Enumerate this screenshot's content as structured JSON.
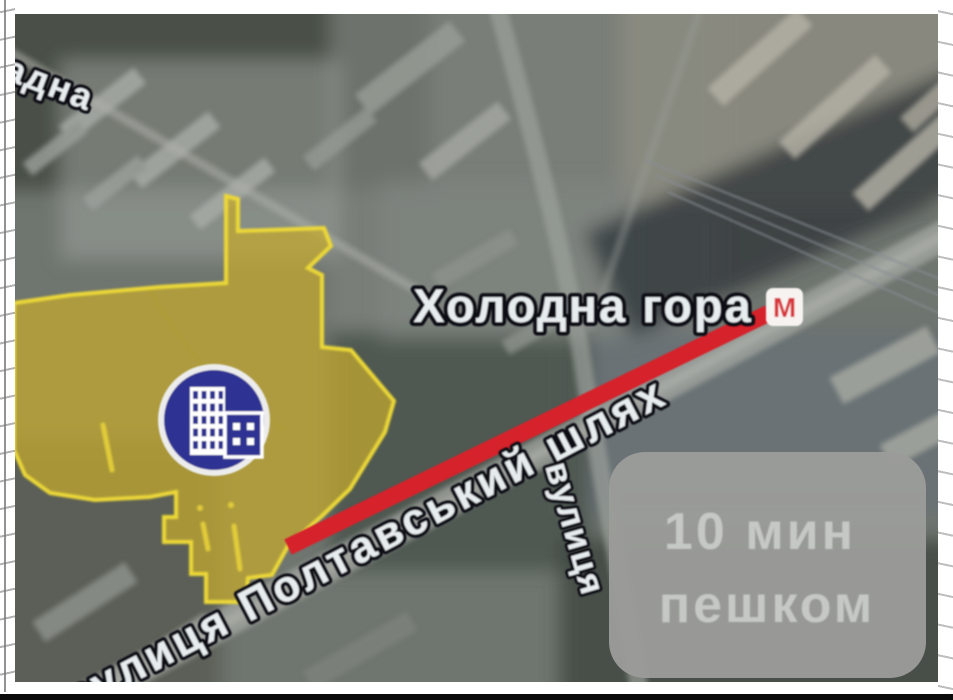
{
  "map": {
    "street_label_top_left": "адна",
    "station_label": "Холодна гора",
    "main_street_label": "вулиця Полтавський шлях",
    "cross_street_label": "вулиця",
    "metro_letter": "М",
    "walk_badge": {
      "duration": "10 мин",
      "mode": "пешком"
    },
    "colors": {
      "highlight_fill": "#c4a82e",
      "highlight_stroke": "#ecd839",
      "route_red": "#d6242b",
      "metro_red": "#d8363b",
      "badge_blue": "#2e3192",
      "overlay_bg": "#9b9c99",
      "overlay_text": "#c6c8c5"
    }
  }
}
